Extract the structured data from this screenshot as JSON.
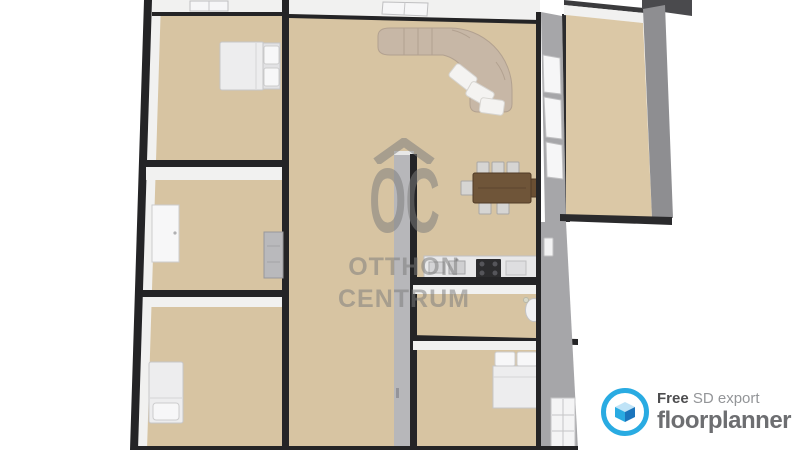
{
  "canvas": {
    "width": 800,
    "height": 450,
    "background": "#ffffff"
  },
  "watermark": {
    "logo_letters": "OC",
    "line1": "OTTHON",
    "line2": "CENTRUM",
    "color": "#7c7c7c"
  },
  "branding": {
    "free_label": "Free",
    "export_label": "SD export",
    "brand_name": "floorplanner",
    "accent_color": "#29abe2",
    "brand_text_color": "#6d6e71",
    "free_text_color": "#4d4d4f",
    "export_text_color": "#939598"
  },
  "floorplan": {
    "view": "3d-top-down-render",
    "colors": {
      "floor": "#d7c4a2",
      "floor_right": "#dbc8a6",
      "wall_cut": "#242426",
      "wall_face": "#f1f1f0",
      "thick_wall": "#a6a6a9",
      "sofa": "#c7b7a6",
      "table": "#6f5539",
      "wm": "#7c7c7c",
      "accent": "#29abe2"
    },
    "rooms": [
      {
        "name": "bedroom-top-left",
        "furniture": [
          "double-bed"
        ],
        "features": [
          "window-top-wall"
        ]
      },
      {
        "name": "room-middle-left",
        "furniture": [
          "wardrobe",
          "radiator-cabinet"
        ],
        "features": []
      },
      {
        "name": "bedroom-bottom-left",
        "furniture": [
          "single-bed"
        ],
        "features": []
      },
      {
        "name": "living-dining-room",
        "furniture": [
          "curved-corner-sofa",
          "dining-table",
          "dining-chairs"
        ],
        "features": [
          "window-top-wall",
          "window-wall-right"
        ]
      },
      {
        "name": "kitchen-zone",
        "furniture": [
          "kitchen-counter",
          "cooktop",
          "sink"
        ],
        "features": []
      },
      {
        "name": "hallway",
        "furniture": [],
        "features": [
          "interior-partition-wall"
        ]
      },
      {
        "name": "bathroom",
        "furniture": [
          "toilet"
        ],
        "features": []
      },
      {
        "name": "bedroom-bottom-right",
        "furniture": [
          "double-bed"
        ],
        "features": [
          "window-right-wall"
        ]
      },
      {
        "name": "balcony-right",
        "furniture": [],
        "features": []
      }
    ]
  }
}
